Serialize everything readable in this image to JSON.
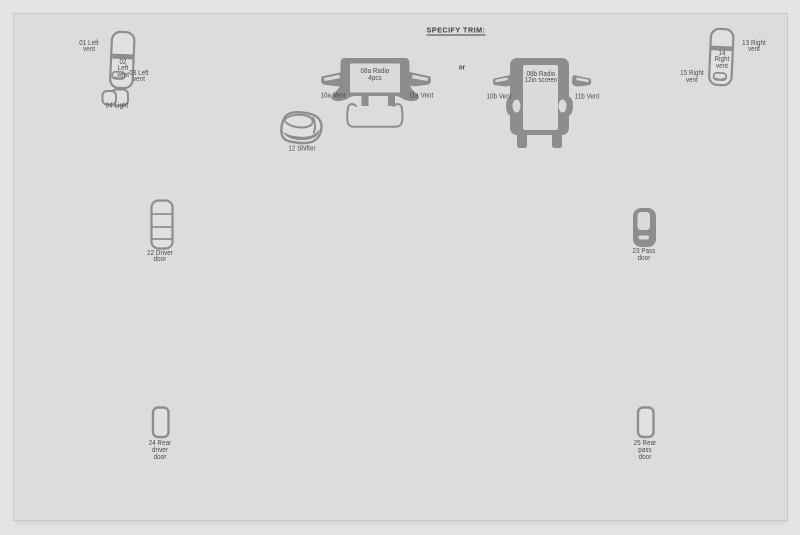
{
  "title": "SPECIFY TRIM:",
  "connector": {
    "or_label": "or"
  },
  "colors": {
    "background": "#dcdcdc",
    "frame_border": "#c9c9c9",
    "shape_dark": "#8d8d8d",
    "shape_outline": "#8e8e8e",
    "shape_light": "#e0e0e0",
    "screen_fill": "#dadada",
    "label_text": "#4a4a4a"
  },
  "parts": {
    "p01": {
      "label": "01 Left\nvent"
    },
    "p02": {
      "label": "02\nLeft\nvent"
    },
    "p03": {
      "label": "03 Left\nvent"
    },
    "p04": {
      "label": "04 Light"
    },
    "p08a": {
      "label": "08a Radio\n4pcs"
    },
    "p10a": {
      "label": "10a Vent"
    },
    "p11a": {
      "label": "11a Vent"
    },
    "p08b": {
      "label": "08b Radio\n12in screen"
    },
    "p10b": {
      "label": "10b Vent"
    },
    "p11b": {
      "label": "11b Vent"
    },
    "p12": {
      "label": "12 Shifter"
    },
    "p13": {
      "label": "13 Right\nvent"
    },
    "p14": {
      "label": "14\nRight\nvent"
    },
    "p15": {
      "label": "15 Right\nvent"
    },
    "p22": {
      "label": "22 Driver\ndoor"
    },
    "p23": {
      "label": "23 Pass\ndoor"
    },
    "p24": {
      "label": "24 Rear\ndriver\ndoor"
    },
    "p25": {
      "label": "25 Rear\npass\ndoor"
    }
  }
}
